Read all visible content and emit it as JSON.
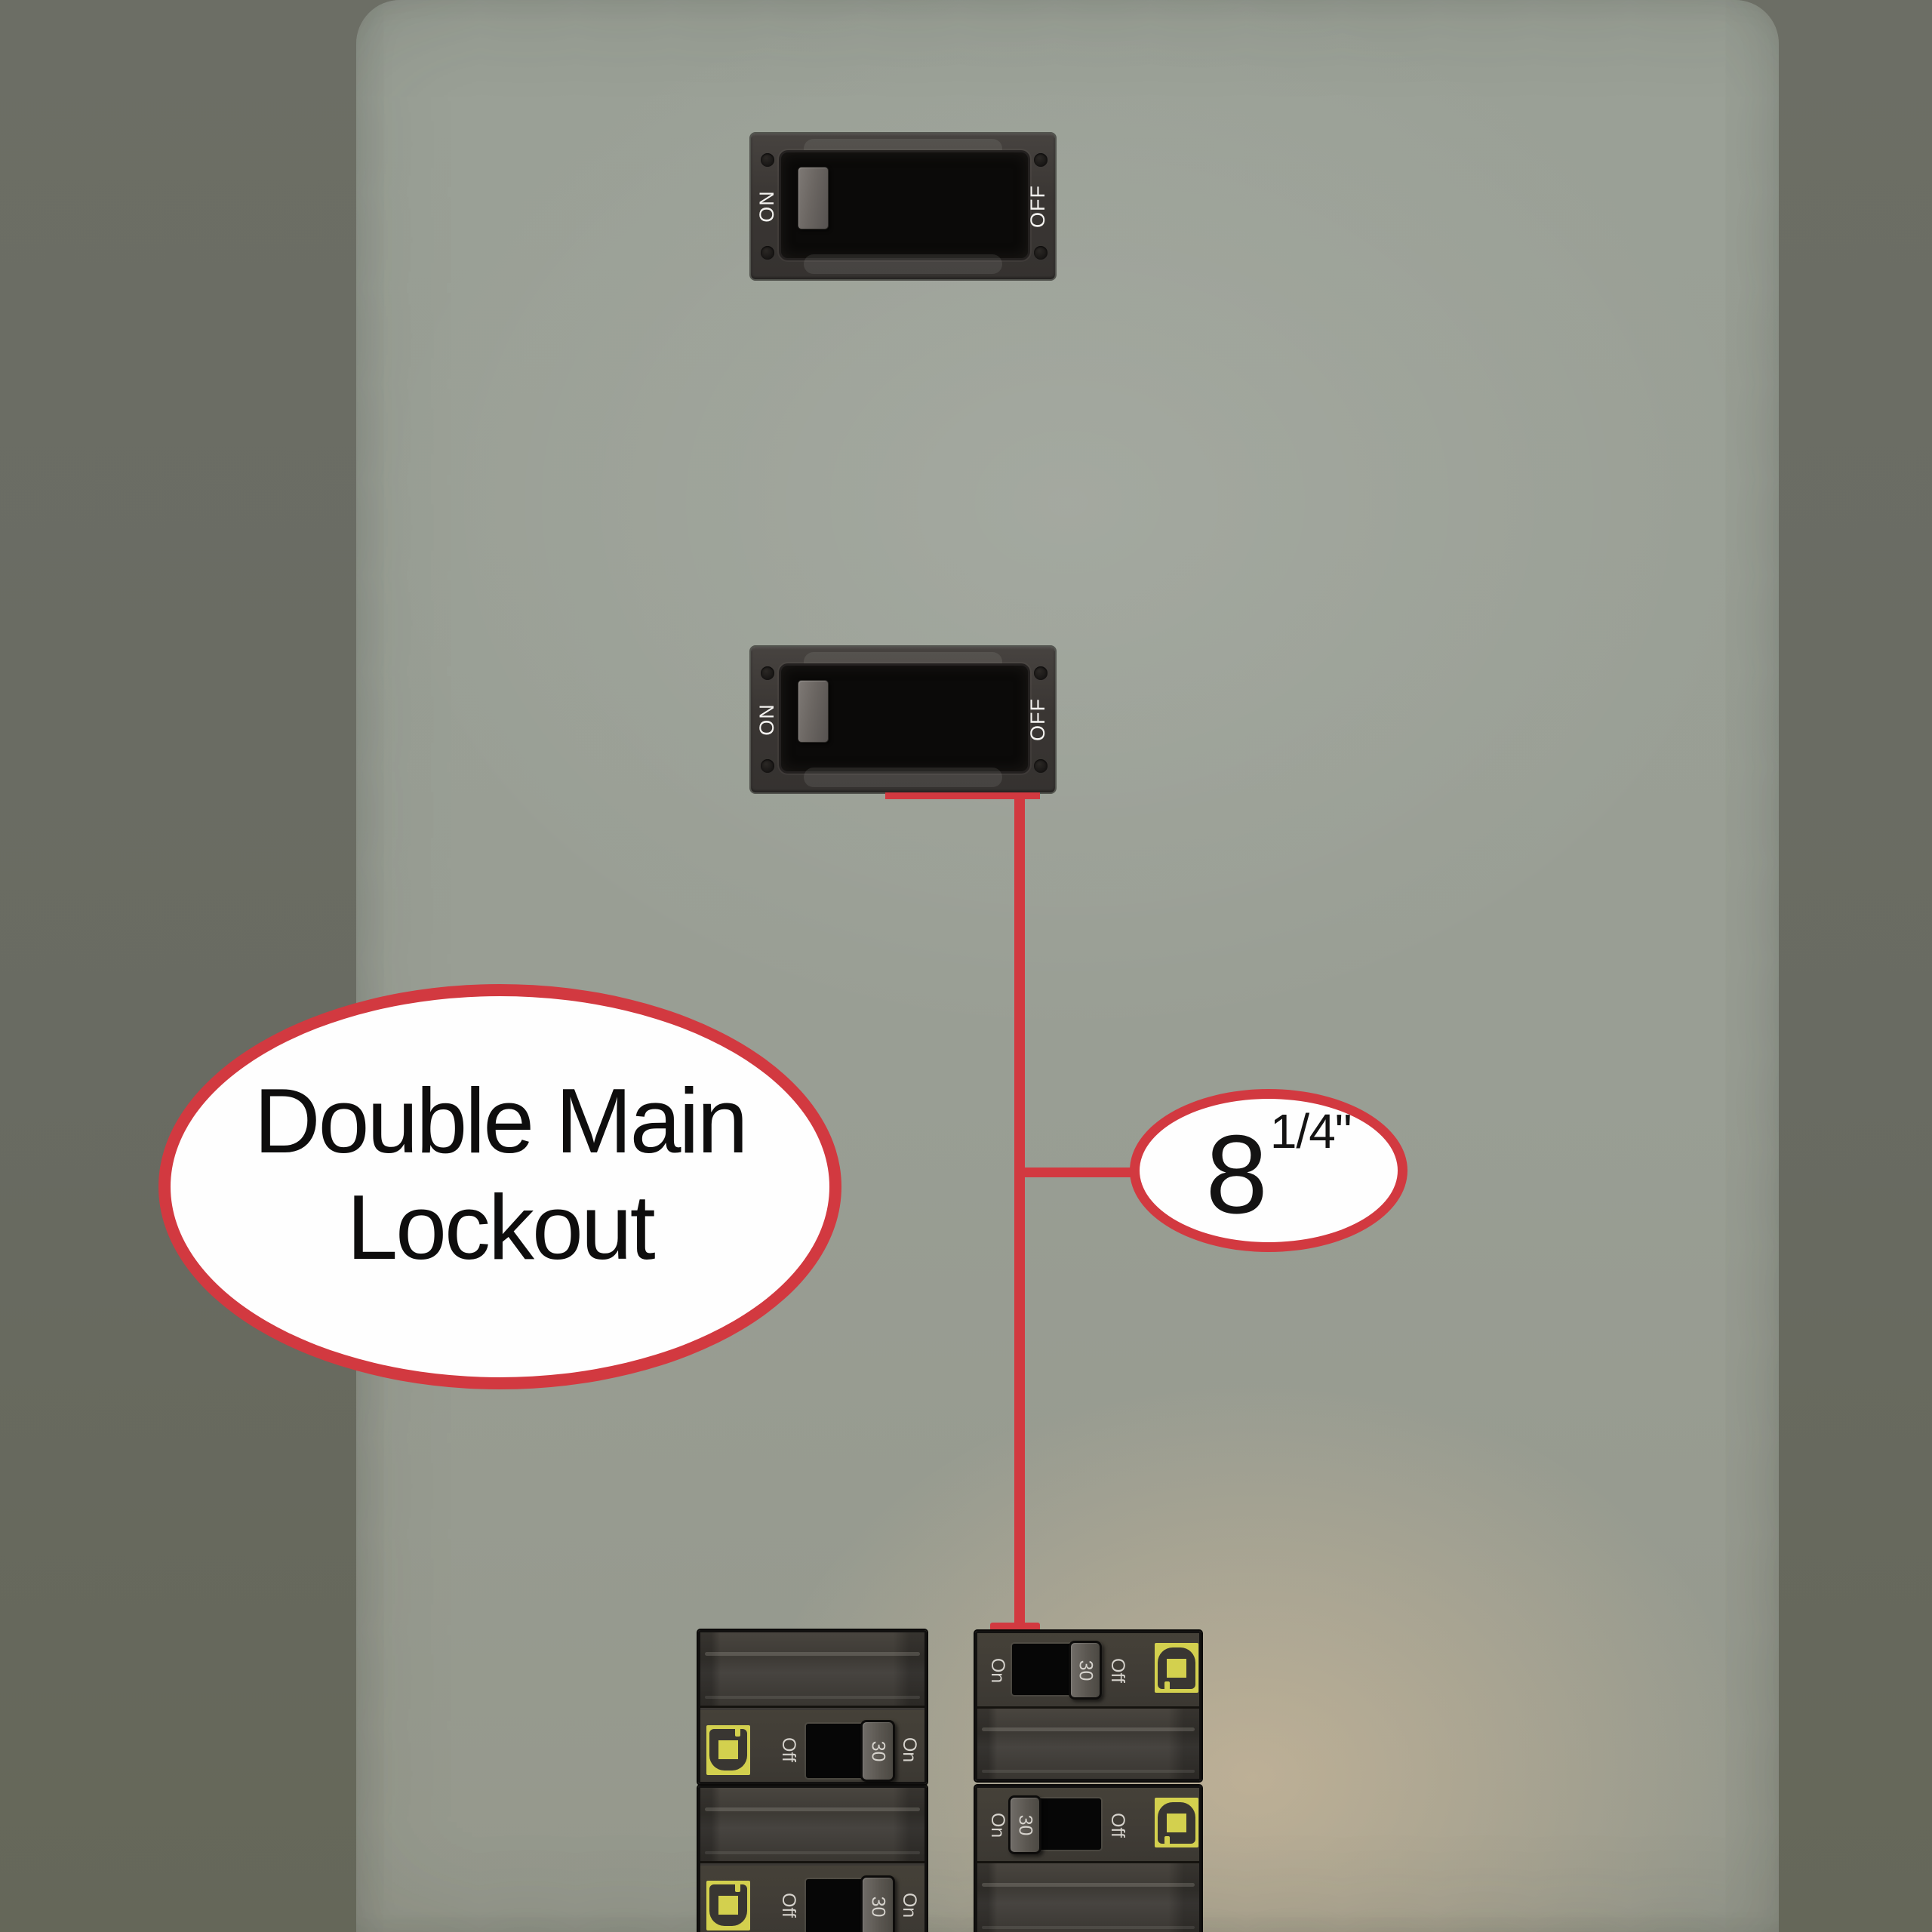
{
  "colors": {
    "accent_red": "#d23940",
    "logo_yellow": "#d3d04e",
    "panel_gray": "#9aa096",
    "background_olive": "#696b62",
    "breaker_body": "#3e3a37",
    "callout_text": "#0e0d0d"
  },
  "main_switches": [
    {
      "on_label": "ON",
      "off_label": "OFF"
    },
    {
      "on_label": "ON",
      "off_label": "OFF"
    }
  ],
  "lockout_callout": {
    "line1": "Double Main",
    "line2": "Lockout"
  },
  "measurement_callout": {
    "number": "8",
    "fraction_label": "1/4\""
  },
  "breakers": {
    "left": [
      {
        "off_label": "Off",
        "amp_label": "30",
        "on_label": "On"
      },
      {
        "off_label": "Off",
        "amp_label": "30",
        "on_label": "On"
      }
    ],
    "right": [
      {
        "on_label": "On",
        "amp_label": "30",
        "off_label": "Off"
      },
      {
        "on_label": "On",
        "amp_label": "30",
        "off_label": "Off"
      }
    ]
  }
}
